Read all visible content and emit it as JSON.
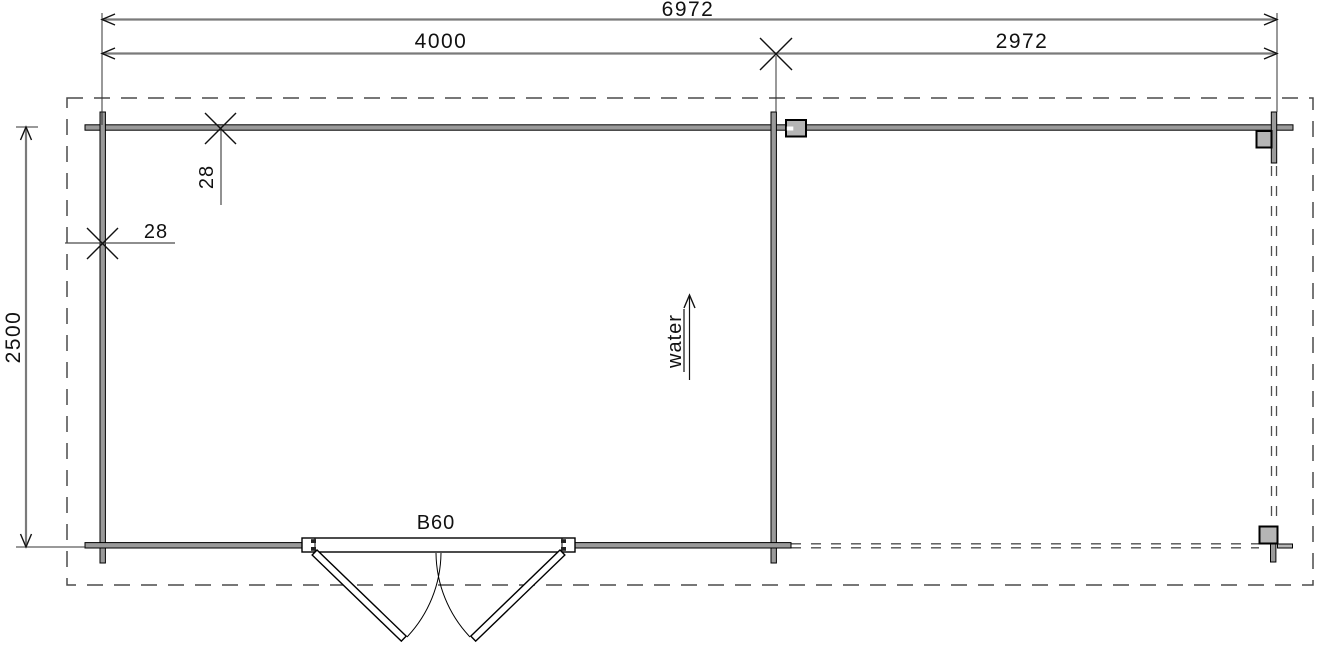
{
  "drawing_title": "log cabin floor plan with canopy",
  "dimensions": {
    "total_width": "6972",
    "cabin_width": "4000",
    "canopy_width": "2972",
    "depth": "2500",
    "back_wall_thickness": "28",
    "side_wall_thickness": "28"
  },
  "labels": {
    "door": "B60",
    "water": "water"
  },
  "colors": {
    "wall_fill": "#9a9a9a",
    "post_fill": "#b5b5b5",
    "dim_line": "#7a7a7a",
    "background": "#ffffff"
  }
}
